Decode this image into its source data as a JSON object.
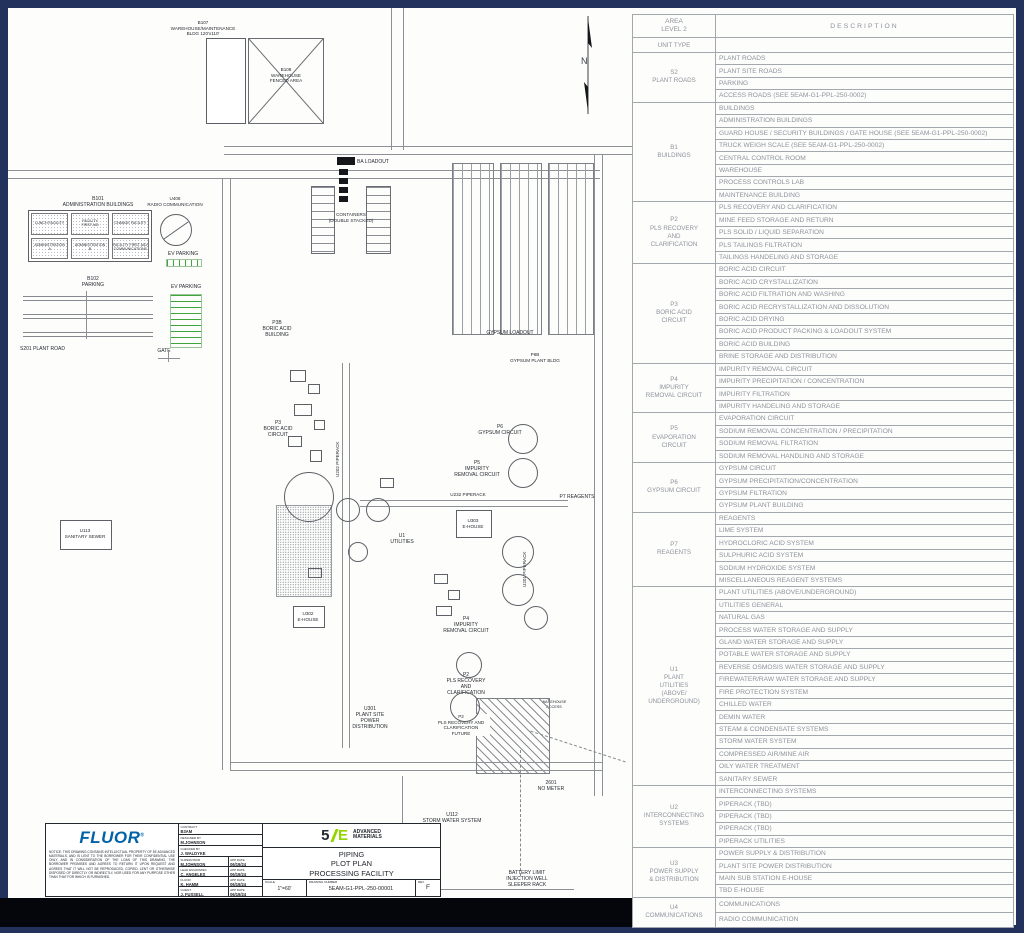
{
  "plot": {
    "north": "N",
    "labels": {
      "b107": "B107\nWAREHOUSE/MAINTENANCE\nBLDG 120'x110'",
      "b108": "B108\nWAREHOUSE\nFENCED AREA",
      "b101_title": "B101\nADMINISTRATION BUILDINGS",
      "admin_cells": [
        "LUNCH FACILITY",
        "FACILITY\nFIRST AID",
        "CHANGE FACILITY",
        "ADMINISTRATION\nA",
        "ADMINISTRATION\nB",
        "FACILITY FIRST AID/\nCOMMUNICATIONS"
      ],
      "u408": "U408\nRADIO COMMUNICATION",
      "ev_parking_1": "EV PARKING",
      "ev_parking_2": "EV PARKING",
      "b102": "B102\nPARKING",
      "s201": "S201 PLANT ROAD",
      "gate": "GATE",
      "u113": "U113\nSANITARY SEWER",
      "ba_loadout": "BA LOADOUT",
      "containers": "CONTAINERS\n(DOUBLE STACKED)",
      "p3b": "P3B\nBORIC ACID\nBUILDING",
      "p3": "P3\nBORIC ACID\nCIRCUIT",
      "u202": "U202 PIPERACK",
      "p5": "P5\nIMPURITY\nREMOVAL CIRCUIT",
      "p6": "P6\nGYPSUM CIRCUIT",
      "p6b": "P6B\nGYPSUM PLANT BLDG",
      "gypsum_loadout": "GYPSUM LOADOUT",
      "u232": "U232 PIPERACK",
      "u303": "U303\nE-HOUSE",
      "u1": "U1\nUTILITIES",
      "p7": "P7 REAGENTS",
      "u201": "U201 PIPERACK",
      "u302": "U302\nE-HOUSE",
      "p4": "P4\nIMPURITY\nREMOVAL CIRCUIT",
      "p2": "P2\nPLS RECOVERY\nAND\nCLARIFICATION",
      "p2_future": "P2\nPLS RECOVERY AND\nCLARIFICATION\nFUTURE",
      "warehouse_access": "WAREHOUSE\nACCESS",
      "u301": "U301\nPLANT SITE\nPOWER\nDISTRIBUTION",
      "u112": "U112\nSTORM WATER SYSTEM",
      "no_meter": "2601\nNO METER",
      "battery_limit": "BATTERY LIMIT\nINJECTION WELL\nSLEEPER RACK"
    }
  },
  "title_block": {
    "fluor_logo": "FLUOR",
    "registered": "®",
    "notice": "NOTICE: THIS DRAWING CONTAINS INTELLECTUAL PROPERTY OF 5E ADVANCED MATERIALS, AND IS LENT TO THE BORROWER FOR THEIR CONFIDENTIAL USE ONLY, AND IN CONSIDERATION OF THE LOAN OF THIS DRAWING, THE BORROWER PROMISES AND AGREES TO RETURN IT UPON REQUEST AND AGREES THAT IT WILL NOT BE REPRODUCED, COPIED, LENT OR OTHERWISE DISPOSED OF DIRECTLY OR INDIRECTLY, NOR USED FOR ANY PURPOSE OTHER THAN THAT FOR WHICH IS FURNISHED.",
    "contract_label": "CONTRACT",
    "contract": "B3AM",
    "designed_label": "DESIGNED BY",
    "designed": "M.JOHNSON",
    "checked_label": "CHECKED BY",
    "checked": "J. WALDYKE",
    "approvals": [
      {
        "role": "SUPERVISOR",
        "name": "M.JOHNSON",
        "date_label": "APP DATE",
        "date": "06/19/24"
      },
      {
        "role": "LEAD ENGR/SPEC",
        "name": "C. ANGELES",
        "date_label": "APP DATE",
        "date": "06/19/24"
      },
      {
        "role": "FLUOR",
        "name": "K. HAMM",
        "date_label": "APP DATE",
        "date": "06/19/24"
      },
      {
        "role": "CLIENT",
        "name": "J. FUSSELL",
        "date_label": "APP DATE",
        "date": "06/19/24"
      }
    ],
    "logo_5": "5",
    "logo_e": "E",
    "brand_line1": "ADVANCED",
    "brand_line2": "MATERIALS",
    "title_line1": "PIPING",
    "title_line2": "PLOT PLAN",
    "title_line3": "PROCESSING FACILITY",
    "scale_label": "SCALE",
    "scale": "1\"=60'",
    "drawing_number_label": "DRAWING NUMBER",
    "drawing_number": "5EAM-G1-PPL-250-00001",
    "rev_label": "REV",
    "rev": "F",
    "brand_green": "#93d500",
    "fluor_blue": "#0063a7"
  },
  "legend_table": {
    "header": {
      "area": "AREA\nLEVEL 2",
      "unit_type": "UNIT TYPE",
      "description": "DESCRIPTION"
    },
    "groups": [
      {
        "unit": "S2\nPLANT ROADS",
        "rows": [
          "PLANT ROADS",
          "PLANT SITE ROADS",
          "PARKING",
          "ACCESS ROADS (SEE 5EAM-G1-PPL-250-0002)"
        ]
      },
      {
        "unit": "B1\nBUILDINGS",
        "rows": [
          "BUILDINGS",
          "ADMINISTRATION BUILDINGS",
          "GUARD HOUSE / SECURITY BUILDINGS / GATE HOUSE (SEE 5EAM-G1-PPL-250-0002)",
          "TRUCK WEIGH SCALE (SEE 5EAM-G1-PPL-250-0002)",
          "CENTRAL CONTROL ROOM",
          "WAREHOUSE",
          "PROCESS CONTROLS LAB",
          "MAINTENANCE BUILDING"
        ]
      },
      {
        "unit": "P2\nPLS RECOVERY\nAND\nCLARIFICATION",
        "rows": [
          "PLS RECOVERY AND CLARIFICATION",
          "MINE FEED STORAGE AND RETURN",
          "PLS SOLID / LIQUID SEPARATION",
          "PLS TAILINGS FILTRATION",
          "TAILINGS HANDELING AND STORAGE"
        ]
      },
      {
        "unit": "P3\nBORIC ACID\nCIRCUIT",
        "rows": [
          "BORIC ACID CIRCUIT",
          "BORIC ACID CRYSTALLIZATION",
          "BORIC ACID FILTRATION AND WASHING",
          "BORIC ACID RECRYSTALLIZATION AND DISSOLUTION",
          "BORIC ACID DRYING",
          "BORIC ACID PRODUCT PACKING & LOADOUT SYSTEM",
          "BORIC ACID BUILDING",
          "BRINE STORAGE AND DISTRIBUTION"
        ]
      },
      {
        "unit": "P4\nIMPURITY\nREMOVAL CIRCUIT",
        "rows": [
          "IMPURITY REMOVAL CIRCUIT",
          "IMPURITY PRECIPITATION / CONCENTRATION",
          "IMPURITY FILTRATION",
          "IMPURITY HANDELING AND STORAGE"
        ]
      },
      {
        "unit": "P5\nEVAPORATION\nCIRCUIT",
        "rows": [
          "EVAPORATION CIRCUIT",
          "SODIUM REMOVAL CONCENTRATION / PRECIPITATION",
          "SODIUM REMOVAL FILTRATION",
          "SODIUM REMOVAL HANDLING AND STORAGE"
        ]
      },
      {
        "unit": "P6\nGYPSUM CIRCUIT",
        "rows": [
          "GYPSUM CIRCUIT",
          "GYPSUM PRECIPITATION/CONCENTRATION",
          "GYPSUM FILTRATION",
          "GYPSUM PLANT BUILDING"
        ]
      },
      {
        "unit": "P7\nREAGENTS",
        "rows": [
          "REAGENTS",
          "LIME SYSTEM",
          "HYDROCLORIC ACID SYSTEM",
          "SULPHURIC ACID SYSTEM",
          "SODIUM HYDROXIDE SYSTEM",
          "MISCELLANEOUS REAGENT SYSTEMS"
        ]
      },
      {
        "unit": "U1\nPLANT\nUTILITIES\n(ABOVE/\nUNDERGROUND)",
        "rows": [
          "PLANT UTILITIES (ABOVE/UNDERGROUND)",
          "UTILITIES GENERAL",
          "NATURAL GAS",
          "PROCESS WATER STORAGE AND SUPPLY",
          "GLAND WATER STORAGE AND SUPPLY",
          "POTABLE WATER STORAGE AND SUPPLY",
          "REVERSE OSMOSIS WATER STORAGE AND SUPPLY",
          "FIREWATER/RAW WATER STORAGE AND SUPPLY",
          "FIRE PROTECTION SYSTEM",
          "CHILLED WATER",
          "DEMIN WATER",
          "STEAM & CONDENSATE SYSTEMS",
          "STORM WATER SYSTEM",
          "COMPRESSED AIR/MINE AIR",
          "OILY WATER TREATMENT",
          "SANITARY SEWER"
        ]
      },
      {
        "unit": "U2\nINTERCONNECTING\nSYSTEMS",
        "rows": [
          "INTERCONNECTING SYSTEMS",
          "PIPERACK (TBD)",
          "PIPERACK (TBD)",
          "PIPERACK  (TBD)",
          "PIPERACK UTILITIES"
        ]
      },
      {
        "unit": "U3\nPOWER SUPPLY\n& DISTRIBUTION",
        "rows": [
          "POWER SUPPLY & DISTRIBUTION",
          "PLANT SITE POWER DISTRIBUTION",
          "MAIN SUB STATION E-HOUSE",
          "TBD E-HOUSE"
        ]
      },
      {
        "unit": "U4\nCOMMUNICATIONS",
        "rows": [
          "COMMUNICATIONS",
          "RADIO COMMUNICATION"
        ]
      }
    ]
  }
}
